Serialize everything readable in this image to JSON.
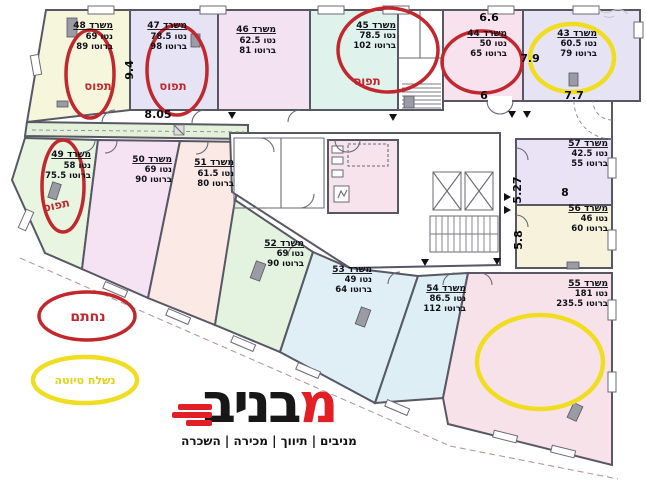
{
  "palette": {
    "red": "#c1272d",
    "yellow": "#f0dd22",
    "yellow_text": "#e5d014",
    "occupied_text": "#c1272d",
    "logo_red": "#e31e24",
    "fills": {
      "r48": "#f6f6dc",
      "r47": "#e6e4f4",
      "r46": "#f3e2f1",
      "r45": "#e0f2ec",
      "r44": "#f8e2ee",
      "r43": "#e6e4f4",
      "corridor": "#e4f1da",
      "r49": "#e8f5e0",
      "r50": "#f5e3f3",
      "r51": "#fae9e4",
      "r52": "#e4f2e0",
      "r53": "#e0eef6",
      "r54": "#ddeef5",
      "r55": "#f8e2ea",
      "r56": "#f7f2dc",
      "r57": "#eae3f5",
      "core": "#ffffff",
      "core_wet": "#f6e3ec",
      "vestibule": "#ffffff"
    }
  },
  "rooms": {
    "r43": {
      "title": "משרד 43",
      "net": "נטו 60.5",
      "gross": "ברוטו 79"
    },
    "r44": {
      "title": "משרד 44",
      "net": "נטו 50",
      "gross": "ברוטו 65"
    },
    "r45": {
      "title": "משרד 45",
      "net": "נטו 78.5",
      "gross": "ברוטו 102"
    },
    "r46": {
      "title": "משרד 46",
      "net": "נטו 62.5",
      "gross": "ברוטו 81"
    },
    "r47": {
      "title": "משרד 47",
      "net": "נטו 78.5",
      "gross": "ברוטו 98"
    },
    "r48": {
      "title": "משרד 48",
      "net": "נטו 69",
      "gross": "ברוטו 89"
    },
    "r49": {
      "title": "משרד 49",
      "net": "נטו 58",
      "gross": "ברוטו 75.5"
    },
    "r50": {
      "title": "משרד 50",
      "net": "נטו 69",
      "gross": "ברוטו 90"
    },
    "r51": {
      "title": "משרד 51",
      "net": "נטו 61.5",
      "gross": "ברוטו 80"
    },
    "r52": {
      "title": "משרד 52",
      "net": "נטו 69",
      "gross": "ברוטו 90"
    },
    "r53": {
      "title": "משרד 53",
      "net": "נטו 49",
      "gross": "ברוטו 64"
    },
    "r54": {
      "title": "משרד 54",
      "net": "נטו 86.5",
      "gross": "ברוטו 112"
    },
    "r55": {
      "title": "משרד 55",
      "net": "נטו 181",
      "gross": "ברוטו 235.5"
    },
    "r56": {
      "title": "משרד 56",
      "net": "נטו 46",
      "gross": "ברוטו 60"
    },
    "r57": {
      "title": "משרד 57",
      "net": "נטו 42.5",
      "gross": "ברוטו 55"
    }
  },
  "annotations": {
    "occupied": "תפוס",
    "signed": "נחתם",
    "draft_sent": "נשלח טיוטה"
  },
  "dims": {
    "a": "9.4",
    "b": "8.05",
    "c": "6.6",
    "d": "6",
    "e": "7.9",
    "f": "7.7",
    "g": "5.27",
    "h": "8",
    "i": "5.8"
  },
  "logo": {
    "first_letter": "מ",
    "rest": "בניב",
    "tagline_bold": "מניבים",
    "tagline_rest": "| תיווך | מכירה | השכרה"
  }
}
